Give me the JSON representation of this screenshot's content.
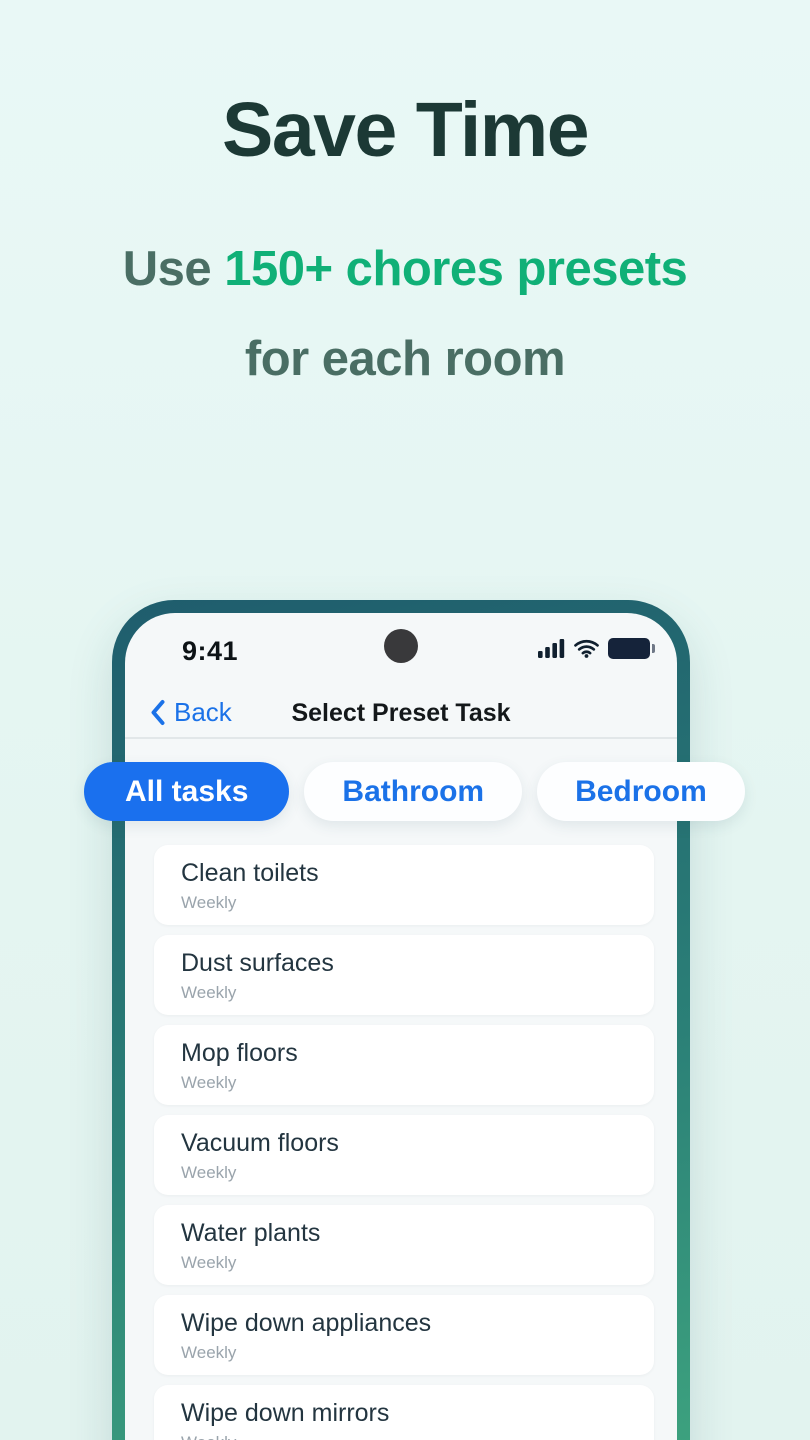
{
  "header": {
    "title": "Save Time",
    "subtitle_prefix": "Use ",
    "subtitle_highlight": "150+ chores presets",
    "subtitle_line2": "for each room"
  },
  "phone": {
    "status_bar": {
      "time": "9:41",
      "icons": [
        "cell-signal-icon",
        "wifi-icon",
        "battery-icon"
      ]
    },
    "nav": {
      "back_label": "Back",
      "back_icon": "chevron-left-icon",
      "title": "Select Preset Task"
    },
    "filters": [
      {
        "label": "All tasks",
        "selected": true
      },
      {
        "label": "Bathroom",
        "selected": false
      },
      {
        "label": "Bedroom",
        "selected": false
      }
    ],
    "tasks": [
      {
        "title": "Clean toilets",
        "frequency": "Weekly"
      },
      {
        "title": "Dust surfaces",
        "frequency": "Weekly"
      },
      {
        "title": "Mop floors",
        "frequency": "Weekly"
      },
      {
        "title": "Vacuum floors",
        "frequency": "Weekly"
      },
      {
        "title": "Water plants",
        "frequency": "Weekly"
      },
      {
        "title": "Wipe down appliances",
        "frequency": "Weekly"
      },
      {
        "title": "Wipe down mirrors",
        "frequency": "Weekly"
      }
    ]
  },
  "colors": {
    "accent_blue": "#1a70ee",
    "accent_green": "#10b077",
    "headline_dark": "#1c3935",
    "subtitle_muted": "#4a6e64",
    "frame_gradient_top": "#1f5d6d",
    "frame_gradient_bottom": "#3ea47f",
    "screen_bg": "#f5f8f9",
    "card_bg": "#ffffff"
  }
}
